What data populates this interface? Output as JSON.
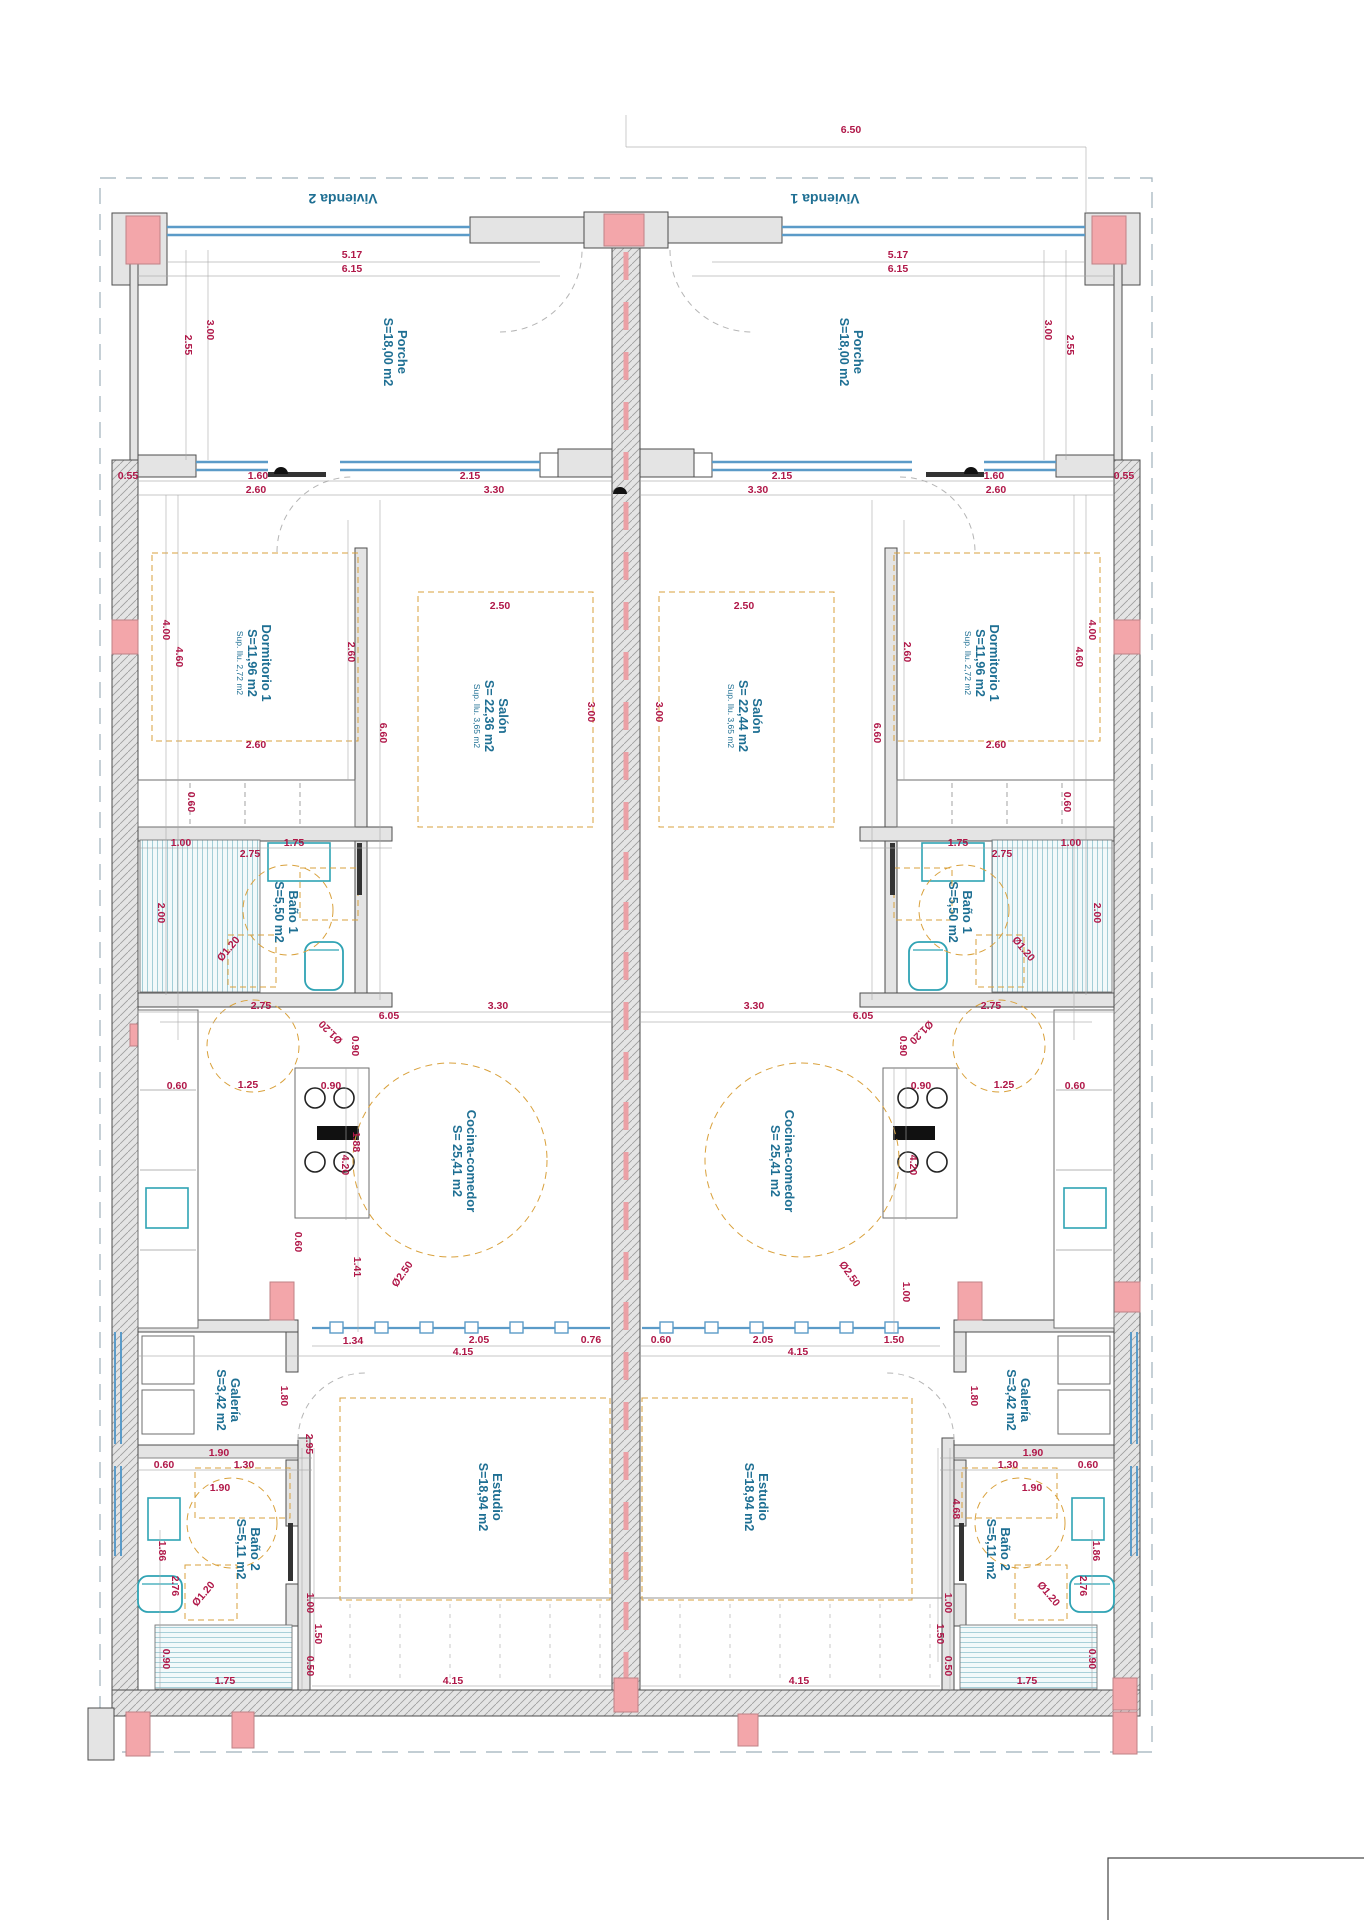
{
  "page": {
    "background": "#ffffff"
  },
  "drawing": {
    "unit_titles": [
      {
        "text": "Vivienda 2",
        "x": 343,
        "y": 194,
        "rot": 180
      },
      {
        "text": "Vivienda 1",
        "x": 825,
        "y": 194,
        "rot": 180
      }
    ],
    "rooms": [
      {
        "name": "Porche",
        "area": "S=18,00 m2",
        "x": 398,
        "y": 352
      },
      {
        "name": "Porche",
        "area": "S=18,00 m2",
        "x": 854,
        "y": 352
      },
      {
        "name": "Dormitorio 1",
        "area": "S=11,96 m2",
        "sup": "Sup. Ilu. 2,72 m2",
        "x": 262,
        "y": 663
      },
      {
        "name": "Dormitorio 1",
        "area": "S=11,96 m2",
        "sup": "Sup. Ilu. 2,72 m2",
        "x": 990,
        "y": 663
      },
      {
        "name": "Salón",
        "area": "S= 22,36 m2",
        "sup": "Sup. Ilu. 3,65 m2",
        "x": 499,
        "y": 716
      },
      {
        "name": "Salón",
        "area": "S= 22,44 m2",
        "sup": "Sup. Ilu. 3,65 m2",
        "x": 753,
        "y": 716
      },
      {
        "name": "Baño 1",
        "area": "S=5,50 m2",
        "x": 289,
        "y": 912
      },
      {
        "name": "Baño 1",
        "area": "S=5,50 m2",
        "x": 963,
        "y": 912
      },
      {
        "name": "Cocina-comedor",
        "area": "S= 25,41 m2",
        "x": 467,
        "y": 1161
      },
      {
        "name": "Cocina-comedor",
        "area": "S= 25,41 m2",
        "x": 785,
        "y": 1161
      },
      {
        "name": "Galería",
        "area": "S=3,42 m2",
        "x": 231,
        "y": 1400
      },
      {
        "name": "Galería",
        "area": "S=3,42 m2",
        "x": 1021,
        "y": 1400
      },
      {
        "name": "Estudio",
        "area": "S=18,94 m2",
        "x": 493,
        "y": 1497
      },
      {
        "name": "Estudio",
        "area": "S=18,94 m2",
        "x": 759,
        "y": 1497
      },
      {
        "name": "Baño 2",
        "area": "S=5,11 m2",
        "x": 251,
        "y": 1549
      },
      {
        "name": "Baño 2",
        "area": "S=5,11 m2",
        "x": 1001,
        "y": 1549
      }
    ],
    "dimensions": [
      {
        "t": "6.50",
        "x": 851,
        "y": 133
      },
      {
        "t": "5.17",
        "x": 352,
        "y": 258
      },
      {
        "t": "6.15",
        "x": 352,
        "y": 272
      },
      {
        "t": "5.17",
        "x": 898,
        "y": 258
      },
      {
        "t": "6.15",
        "x": 898,
        "y": 272
      },
      {
        "t": "3.00",
        "x": 207,
        "y": 330,
        "r": 90
      },
      {
        "t": "2.55",
        "x": 185,
        "y": 345,
        "r": 90
      },
      {
        "t": "3.00",
        "x": 1045,
        "y": 330,
        "r": 90
      },
      {
        "t": "2.55",
        "x": 1067,
        "y": 345,
        "r": 90
      },
      {
        "t": "0.55",
        "x": 128,
        "y": 479
      },
      {
        "t": "1.60",
        "x": 258,
        "y": 479
      },
      {
        "t": "2.60",
        "x": 256,
        "y": 493
      },
      {
        "t": "2.15",
        "x": 470,
        "y": 479
      },
      {
        "t": "3.30",
        "x": 494,
        "y": 493
      },
      {
        "t": "2.15",
        "x": 782,
        "y": 479
      },
      {
        "t": "3.30",
        "x": 758,
        "y": 493
      },
      {
        "t": "1.60",
        "x": 994,
        "y": 479
      },
      {
        "t": "2.60",
        "x": 996,
        "y": 493
      },
      {
        "t": "0.55",
        "x": 1124,
        "y": 479
      },
      {
        "t": "4.00",
        "x": 163,
        "y": 630,
        "r": 90
      },
      {
        "t": "4.60",
        "x": 176,
        "y": 657,
        "r": 90
      },
      {
        "t": "4.00",
        "x": 1089,
        "y": 630,
        "r": 90
      },
      {
        "t": "4.60",
        "x": 1076,
        "y": 657,
        "r": 90
      },
      {
        "t": "2.60",
        "x": 348,
        "y": 652,
        "r": 90
      },
      {
        "t": "2.60",
        "x": 904,
        "y": 652,
        "r": 90
      },
      {
        "t": "2.50",
        "x": 500,
        "y": 609
      },
      {
        "t": "2.50",
        "x": 744,
        "y": 609
      },
      {
        "t": "3.00",
        "x": 588,
        "y": 712,
        "r": 90
      },
      {
        "t": "3.00",
        "x": 656,
        "y": 712,
        "r": 90
      },
      {
        "t": "6.60",
        "x": 380,
        "y": 733,
        "r": 90
      },
      {
        "t": "6.60",
        "x": 874,
        "y": 733,
        "r": 90
      },
      {
        "t": "2.60",
        "x": 256,
        "y": 748
      },
      {
        "t": "2.60",
        "x": 996,
        "y": 748
      },
      {
        "t": "0.60",
        "x": 188,
        "y": 802,
        "r": 90
      },
      {
        "t": "0.60",
        "x": 1064,
        "y": 802,
        "r": 90
      },
      {
        "t": "1.00",
        "x": 181,
        "y": 846
      },
      {
        "t": "2.75",
        "x": 250,
        "y": 857
      },
      {
        "t": "1.75",
        "x": 294,
        "y": 846
      },
      {
        "t": "1.75",
        "x": 958,
        "y": 846
      },
      {
        "t": "2.75",
        "x": 1002,
        "y": 857
      },
      {
        "t": "1.00",
        "x": 1071,
        "y": 846
      },
      {
        "t": "2.00",
        "x": 158,
        "y": 913,
        "r": 90
      },
      {
        "t": "2.00",
        "x": 1094,
        "y": 913,
        "r": 90
      },
      {
        "t": "Ø1.20",
        "x": 231,
        "y": 951,
        "r": -50
      },
      {
        "t": "Ø1.20",
        "x": 1021,
        "y": 951,
        "r": 50
      },
      {
        "t": "2.75",
        "x": 261,
        "y": 1009
      },
      {
        "t": "6.05",
        "x": 389,
        "y": 1019
      },
      {
        "t": "3.30",
        "x": 498,
        "y": 1009
      },
      {
        "t": "3.30",
        "x": 754,
        "y": 1009
      },
      {
        "t": "6.05",
        "x": 863,
        "y": 1019
      },
      {
        "t": "2.75",
        "x": 991,
        "y": 1009
      },
      {
        "t": "Ø1.20",
        "x": 333,
        "y": 1030,
        "r": -135
      },
      {
        "t": "Ø1.20",
        "x": 919,
        "y": 1030,
        "r": 135
      },
      {
        "t": "0.90",
        "x": 352,
        "y": 1046,
        "r": 90
      },
      {
        "t": "0.90",
        "x": 900,
        "y": 1046,
        "r": 90
      },
      {
        "t": "0.60",
        "x": 177,
        "y": 1089
      },
      {
        "t": "1.25",
        "x": 248,
        "y": 1088
      },
      {
        "t": "0.90",
        "x": 331,
        "y": 1089
      },
      {
        "t": "0.60",
        "x": 1075,
        "y": 1089
      },
      {
        "t": "1.25",
        "x": 1004,
        "y": 1088
      },
      {
        "t": "0.90",
        "x": 921,
        "y": 1089
      },
      {
        "t": "1.88",
        "x": 353,
        "y": 1142,
        "r": 90
      },
      {
        "t": "4.20",
        "x": 342,
        "y": 1165,
        "r": 90
      },
      {
        "t": "4.20",
        "x": 910,
        "y": 1165,
        "r": 90
      },
      {
        "t": "0.60",
        "x": 295,
        "y": 1242,
        "r": 90
      },
      {
        "t": "1.41",
        "x": 354,
        "y": 1267,
        "r": 90
      },
      {
        "t": "1.00",
        "x": 903,
        "y": 1292,
        "r": 90
      },
      {
        "t": "Ø2.50",
        "x": 405,
        "y": 1276,
        "r": -55
      },
      {
        "t": "Ø2.50",
        "x": 847,
        "y": 1276,
        "r": 55
      },
      {
        "t": "1.34",
        "x": 353,
        "y": 1344
      },
      {
        "t": "2.05",
        "x": 479,
        "y": 1343
      },
      {
        "t": "0.76",
        "x": 591,
        "y": 1343
      },
      {
        "t": "4.15",
        "x": 463,
        "y": 1355
      },
      {
        "t": "0.60",
        "x": 661,
        "y": 1343
      },
      {
        "t": "2.05",
        "x": 763,
        "y": 1343
      },
      {
        "t": "1.50",
        "x": 894,
        "y": 1343
      },
      {
        "t": "4.15",
        "x": 798,
        "y": 1355
      },
      {
        "t": "1.80",
        "x": 281,
        "y": 1396,
        "r": 90
      },
      {
        "t": "1.80",
        "x": 971,
        "y": 1396,
        "r": 90
      },
      {
        "t": "1.90",
        "x": 219,
        "y": 1456
      },
      {
        "t": "1.30",
        "x": 244,
        "y": 1468
      },
      {
        "t": "0.60",
        "x": 164,
        "y": 1468
      },
      {
        "t": "1.90",
        "x": 1033,
        "y": 1456
      },
      {
        "t": "1.30",
        "x": 1008,
        "y": 1468
      },
      {
        "t": "0.60",
        "x": 1088,
        "y": 1468
      },
      {
        "t": "2.95",
        "x": 306,
        "y": 1444,
        "r": 90
      },
      {
        "t": "4.68",
        "x": 953,
        "y": 1509,
        "r": 90
      },
      {
        "t": "1.90",
        "x": 220,
        "y": 1491
      },
      {
        "t": "1.90",
        "x": 1032,
        "y": 1491
      },
      {
        "t": "1.86",
        "x": 159,
        "y": 1551,
        "r": 90
      },
      {
        "t": "1.86",
        "x": 1093,
        "y": 1551,
        "r": 90
      },
      {
        "t": "2.76",
        "x": 172,
        "y": 1586,
        "r": 90
      },
      {
        "t": "2.76",
        "x": 1080,
        "y": 1586,
        "r": 90
      },
      {
        "t": "Ø1.20",
        "x": 206,
        "y": 1596,
        "r": -50
      },
      {
        "t": "Ø1.20",
        "x": 1046,
        "y": 1596,
        "r": 50
      },
      {
        "t": "1.00",
        "x": 307,
        "y": 1603,
        "r": 90
      },
      {
        "t": "1.00",
        "x": 945,
        "y": 1603,
        "r": 90
      },
      {
        "t": "1.50",
        "x": 315,
        "y": 1634,
        "r": 90
      },
      {
        "t": "1.50",
        "x": 937,
        "y": 1634,
        "r": 90
      },
      {
        "t": "0.90",
        "x": 163,
        "y": 1659,
        "r": 90
      },
      {
        "t": "0.90",
        "x": 1089,
        "y": 1659,
        "r": 90
      },
      {
        "t": "0.50",
        "x": 307,
        "y": 1666,
        "r": 90
      },
      {
        "t": "0.50",
        "x": 945,
        "y": 1666,
        "r": 90
      },
      {
        "t": "1.75",
        "x": 225,
        "y": 1684
      },
      {
        "t": "1.75",
        "x": 1027,
        "y": 1684
      },
      {
        "t": "4.15",
        "x": 453,
        "y": 1684
      },
      {
        "t": "4.15",
        "x": 799,
        "y": 1684
      }
    ],
    "colors": {
      "wall": "#e4e4e4",
      "wall_stroke": "#4d4d4d",
      "hatch": "#9c9c9c",
      "column": "#f3a6aa",
      "column_stroke": "#bf8186",
      "dim": "#b01748",
      "label": "#1e6f93",
      "window": "#5b9bc8",
      "fixture": "#2fa3b4",
      "illum": "#d9a13c",
      "boundary": "#9fb0bb",
      "centerline": "#eba0a5",
      "dimline": "#a9a9a9",
      "arc": "#b5b5b5",
      "dark": "#333333"
    }
  }
}
